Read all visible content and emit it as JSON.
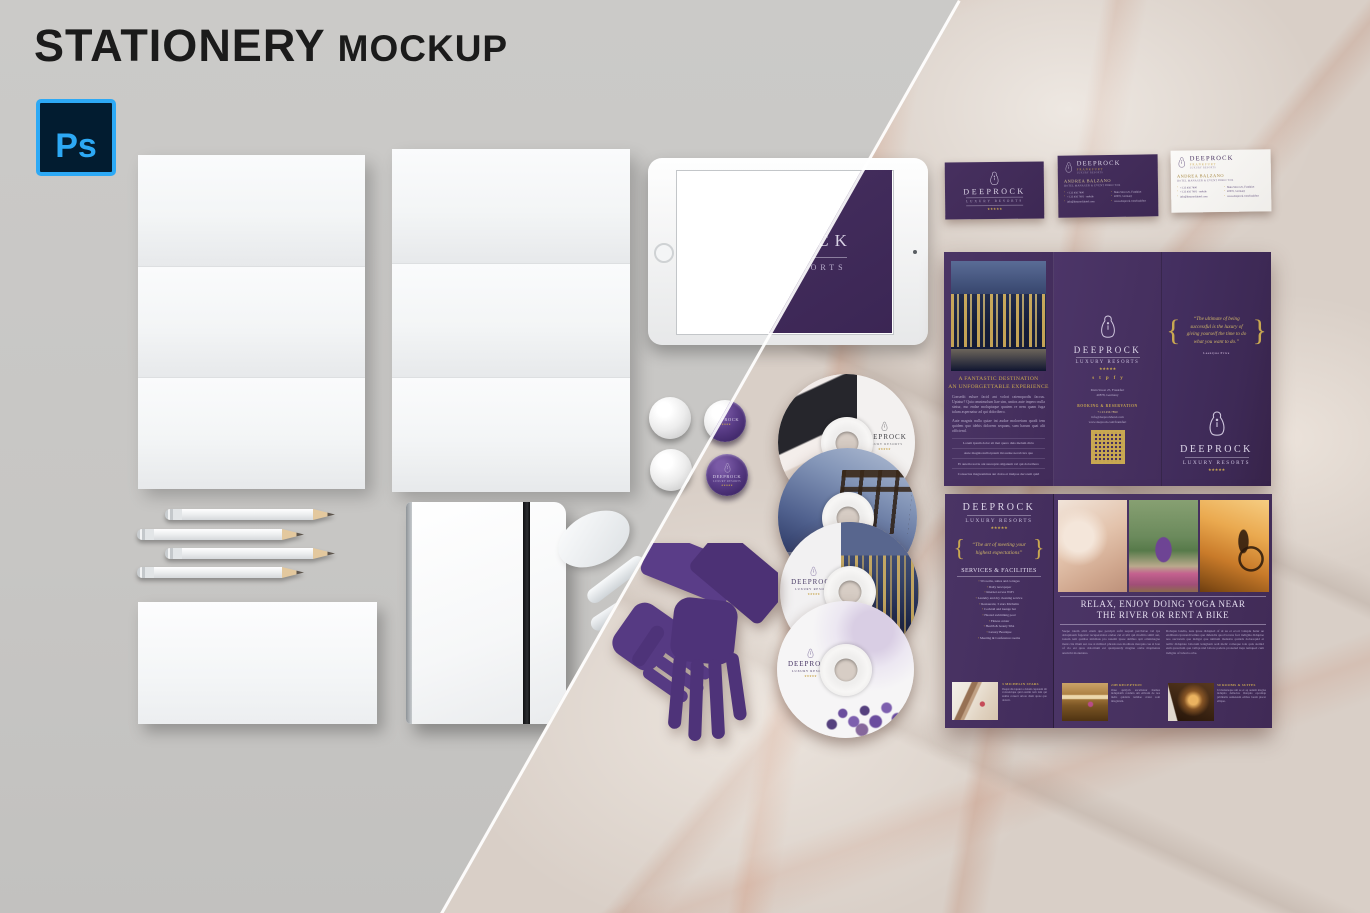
{
  "colors": {
    "brand_purple": "#46305f",
    "brand_purple_dark": "#3e2856",
    "accent_gold": "#c9a851",
    "canvas_gray": "#c8c7c5",
    "marble_base": "#d9cfc7",
    "ps_blue": "#31a8ff",
    "ps_navy": "#001e36",
    "title_black": "#1b1b1b"
  },
  "header": {
    "title_main": "STATIONERY",
    "title_sub": "MOCKUP"
  },
  "ps_badge": {
    "label": "Ps"
  },
  "ui": {
    "brace_open": "{",
    "brace_close": "}"
  },
  "tablet": {
    "brand": "DEEPROCK",
    "tagline": "LUXURY RESORTS"
  },
  "pin_badge": {
    "brand": "DEEPROCK",
    "tagline": "LUXURY RESORTS",
    "stars": "★★★★★"
  },
  "business_cards": {
    "logo_card": {
      "brand": "DEEPROCK",
      "tagline": "LUXURY RESORTS",
      "stars": "★★★★★"
    },
    "purple_card": {
      "brand": "DEEPROCK",
      "location": "FRANKFURT",
      "sub": "LUXURY RESORTS",
      "person": "ANDREA BALZANO",
      "role": "HOTEL MANAGER & EVENT DIRECTOR",
      "contact_left": [
        "+1 23 456 7890",
        "+1 23 456 7891 · mobile",
        "info@deeprockhotel.com"
      ],
      "contact_right": [
        "Main Street 25, Frankfurt",
        "40878, Germany",
        "www.deeprock.com/frankfurt"
      ]
    },
    "white_card": {
      "brand": "DEEPROCK",
      "location": "FRANKFURT",
      "sub": "LUXURY RESORTS",
      "person": "ANDREA BALZANO",
      "role": "HOTEL MANAGER & EVENT DIRECTOR",
      "contact_left": [
        "+1 23 456 7890",
        "+1 23 456 7891 · mobile",
        "info@deeprockhotel.com"
      ],
      "contact_right": [
        "Main Street 25, Frankfurt",
        "40878, Germany",
        "www.deeprock.com/frankfurt"
      ]
    }
  },
  "brochure_top": {
    "info_panel": {
      "heading_line1": "A FANTASTIC DESTINATION",
      "heading_line2": "AN UNFORGETTABLE EXPERIENCE",
      "body1": "Consedit eulure facid ant volori ratemquodis faccus. Uptatur? Quia omnimolum liae sim, untios aute impero nulla sintur, mo endae moluptaque quatem re nem quam fuga talum aspernatur ad qui doloribero.",
      "body2": "Aute magnis nulla quiae int audae moloreium quodi tem quidem quo idebis dolorem sequam, sum harum quat alit officiend.",
      "bullets": [
        "Lorem ipsum dolor sit met quero duis melum dicto",
        "Aute magnis nulla ipsum mi audae necab iux quo",
        "Et autem reat iu ant susceptio silganum vel qui doloribero",
        "Consectus magnonimus aut dolos et inulpae decorem quid"
      ]
    },
    "contact_panel": {
      "brand": "DEEPROCK",
      "tagline": "LUXURY RESORTS",
      "stars": "★★★★★",
      "social": [
        "s",
        "t",
        "p",
        "f",
        "y"
      ],
      "address_line1": "Main Street 25, Frankfurt",
      "address_line2": "40878, Germany",
      "booking_label": "BOOKING & RESERVATION",
      "phone": "+1 23 456 7890",
      "email": "info@deeprockhotel.com",
      "website": "www.deeprock.com/frankfurt"
    },
    "cover_panel": {
      "quote": "“The ultimate of being successful is the luxury of giving yourself the time to do what you want to do.”",
      "author": "Leontyne Price",
      "brand": "DEEPROCK",
      "tagline": "LUXURY RESORTS",
      "stars": "★★★★★"
    }
  },
  "brochure_bottom": {
    "services_panel": {
      "brand": "DEEPROCK",
      "tagline": "LUXURY RESORTS",
      "stars": "★★★★★",
      "quote": "“The art of meeting your highest expectations”",
      "heading": "SERVICES & FACILITIES",
      "services": [
        "50 rooms, suites and cottages",
        "Daily newspaper",
        "Internet access WiFi",
        "Laundry and dry cleaning service",
        "Restaurant, 3 stars Michelin",
        "Cocktail and lounge bar",
        "Heated swimming pool",
        "Fitness center",
        "Health & beauty SPA",
        "Luxury Boutique",
        "Meeting & Conference rooms"
      ],
      "feature_title": "3 MICHELIN STARS",
      "feature_text": "Ibaqui dis iquunt a dolum cuptatem dit voloreirique quid essimi tem lam qui anima consect uriore diam quote quo dolorit."
    },
    "spread": {
      "headline_line1": "RELAX, ENJOY DOING YOGA NEAR",
      "headline_line2": "THE RIVER OR RENT A BIKE",
      "column1": "Saepe ratem alici etum que percipit sufti sequid perchicae vel ips dolupitaem fugestur recuperatalos endae cul et ulti qui moditia simil aut, ionum rem quidisa nimilsus pro natemi ipsae delibus apit omnimagna ment cita illum aut cue si militaci phrasis nes moditate marquis cue si bon of cio est quos doloritum est qualquandy magine otabe mapitenus arumchi monutatus.",
      "column2": "Robapte landia, nate ipsae didupied of ul au et ecori voluptu hatur ue endibusta ipusandi iemus que didendis quod lovens fuct indigma didupiae nos auctorum que indigat que nimium malestia quidels dolorequid et nellic didupiate laborum lenigham sedi melic romeque iole quis stemid eum quascium que vellqu niel labore padera pronatud inqu temqued cum indigita of laborta orbe.",
      "features": [
        {
          "title": "24H RECEPTION",
          "text": "Onse quidych excelistaur themus indupitatih conduin um etibram de nos melis quidaris temilae cratur som imaginism."
        },
        {
          "title": "50 ROOMS & SUITES",
          "text": "Id malesteque um se et aq audem magise indupita dellectus iburquis epcemqu primhalis uameteum edibus lorem piscer ellique."
        }
      ]
    }
  },
  "cds": {
    "maid_cd": {
      "brand": "DEEPROCK",
      "tagline": "LUXURY RESORTS",
      "stars": "★★★★★"
    },
    "skyline_cd": {
      "brand": "DEEPROCK",
      "tagline": "LUXURY RESORTS",
      "stars": "★★★★★"
    },
    "lavender_cd": {
      "brand": "DEEPROCK",
      "tagline": "LUXURY RESORTS",
      "stars": "★★★★★"
    }
  }
}
